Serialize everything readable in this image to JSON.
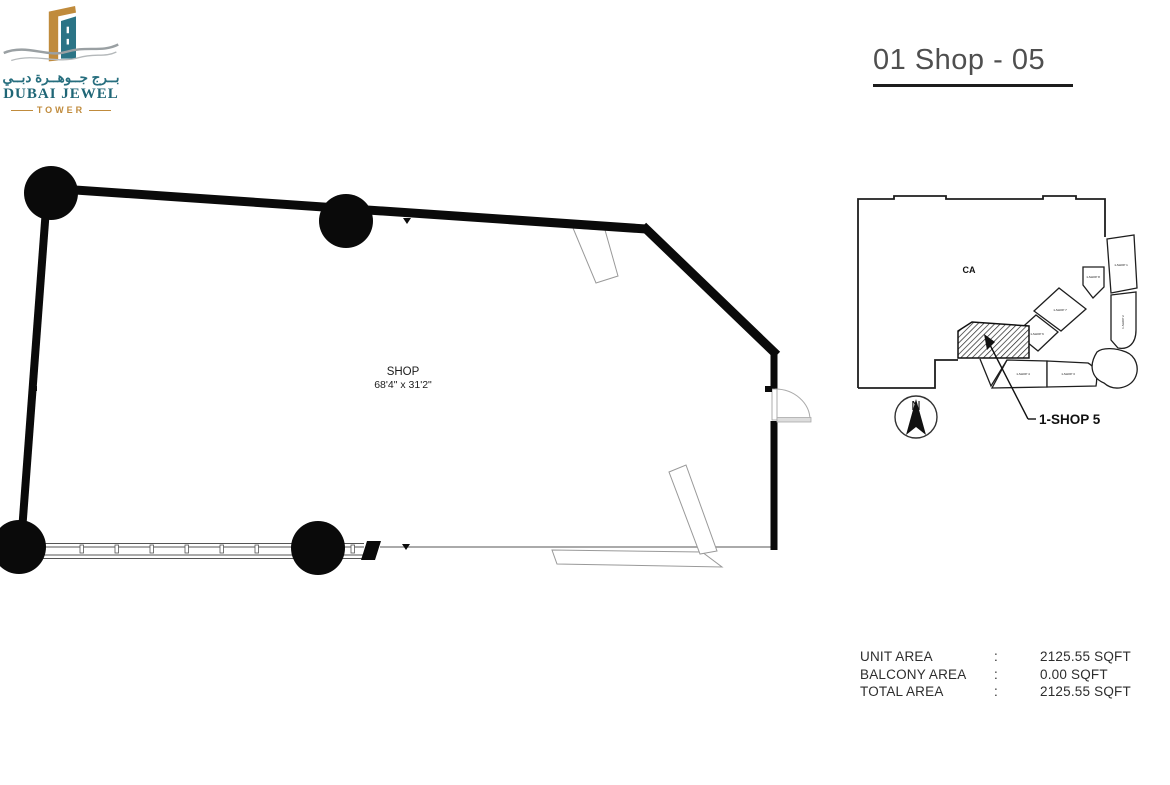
{
  "logo": {
    "brand_arabic": "بــرج جــوهــرة دبــي",
    "brand_name": "DUBAI JEWEL",
    "brand_sub": "TOWER",
    "teal": "#266e7e",
    "gold": "#c08b3c"
  },
  "header": {
    "title": "01 Shop - 05"
  },
  "floor_plan": {
    "room_label": "SHOP",
    "room_dimensions": "68'4\" x 31'2\""
  },
  "key_plan": {
    "common_area_label": "CA",
    "highlight_label": "1-SHOP 5",
    "north_label": "N",
    "unit_labels": [
      {
        "text": "1-SHOP 1"
      },
      {
        "text": "1-SHOP 2"
      },
      {
        "text": "1-SHOP 3"
      },
      {
        "text": "1-SHOP 4"
      },
      {
        "text": "1-SHOP 6"
      },
      {
        "text": "1-SHOP 7"
      },
      {
        "text": "1-SHOP 8"
      }
    ]
  },
  "area_table": {
    "rows": [
      {
        "label": "UNIT AREA",
        "separator": ":",
        "value": "2125.55 SQFT"
      },
      {
        "label": "BALCONY AREA",
        "separator": ":",
        "value": "0.00 SQFT"
      },
      {
        "label": "TOTAL AREA",
        "separator": ":",
        "value": "2125.55 SQFT"
      }
    ]
  }
}
